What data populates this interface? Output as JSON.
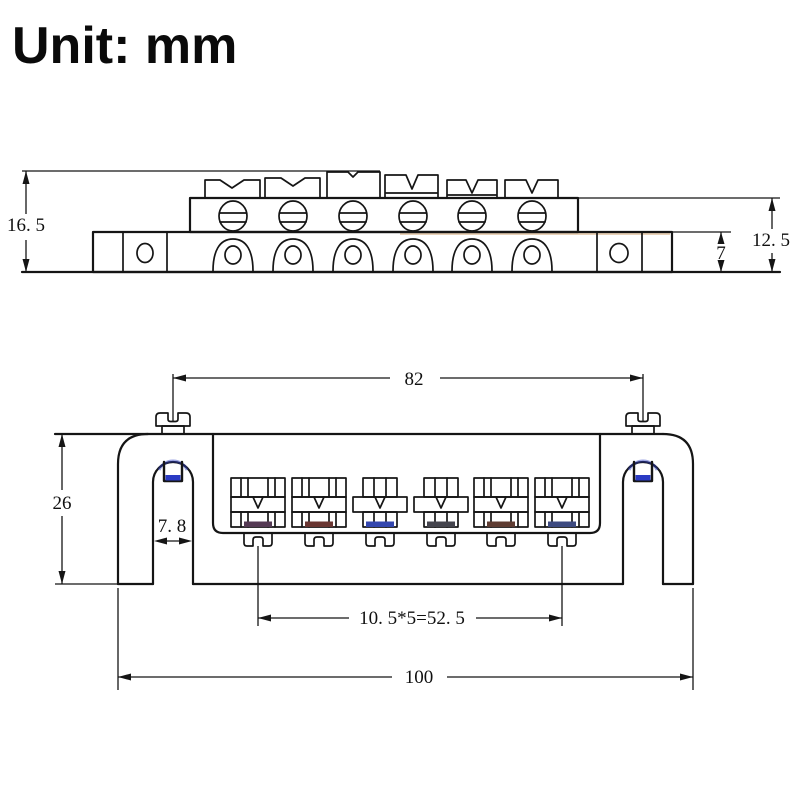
{
  "title": "Unit: mm",
  "colors": {
    "line": "#151515",
    "accent_blue": "#2b3bc4",
    "saddle_bar_colors": [
      "#553a54",
      "#6a3632",
      "#3346ae",
      "#45454e",
      "#5e3c32",
      "#3d4a80"
    ]
  },
  "side_view": {
    "label": "bridge-side-elevation",
    "dims": {
      "total_height": "16. 5",
      "upper_height": "12. 5",
      "base_thickness": "7"
    }
  },
  "front_view": {
    "label": "bridge-front-elevation",
    "dims": {
      "post_spacing": "82",
      "overall_height": "26",
      "leg_slot_width": "7. 8",
      "string_spacing": "10. 5*5=52. 5",
      "overall_width": "100"
    }
  }
}
